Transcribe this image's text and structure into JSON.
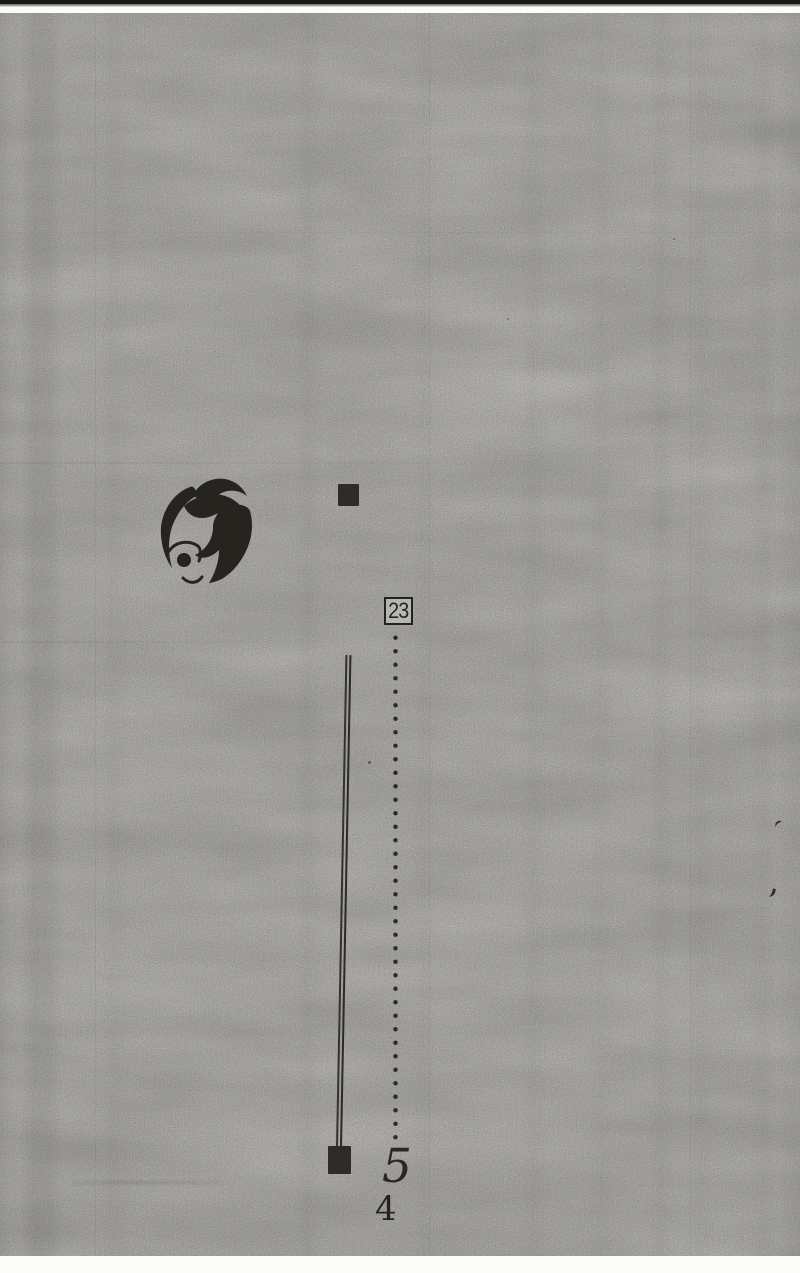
{
  "colors": {
    "paper": "#f2f0ed",
    "ink": "#26241f",
    "scan_edge": "#181816",
    "square": "#2e2c29"
  },
  "content": {
    "ref_box_label": "23",
    "figure_value": "5",
    "page_number": "4"
  },
  "icons": {
    "illustration": "woman-face-with-swirling-hair",
    "top_marker": "black-square",
    "bottom_marker": "black-square",
    "double_rule": "double-vertical-line",
    "dotted_rule": "dotted-vertical-line"
  }
}
